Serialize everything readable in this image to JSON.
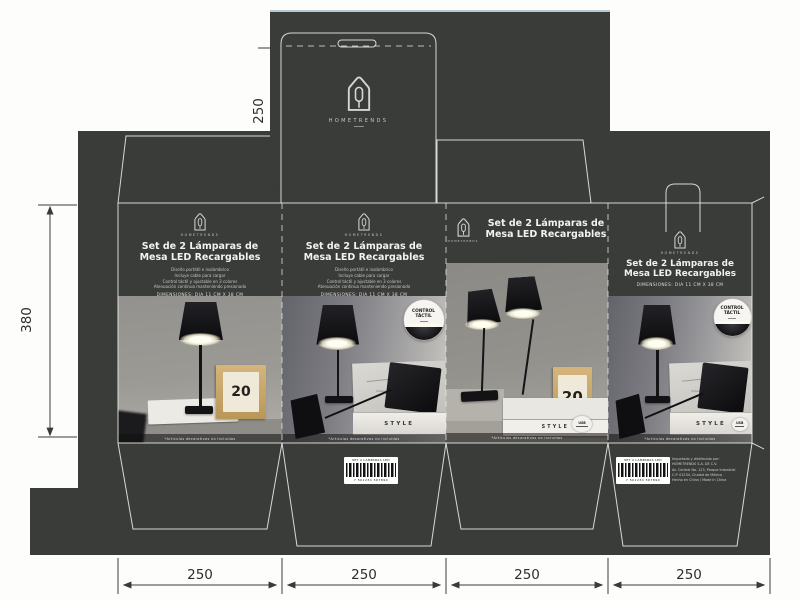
{
  "colors": {
    "sheet": "#3a3c39",
    "dieline": "#e9e9e4",
    "dimension_lines": "#3a3a3a",
    "calendar_wood": "#c9a869"
  },
  "brand": {
    "name": "HOMETRENDS"
  },
  "panel": {
    "title_line1": "Set de 2 Lámparas de",
    "title_line2": "Mesa LED Recargables",
    "features": [
      "Diseño portátil e inalámbrico",
      "Incluye cable para cargar",
      "Control táctil y ajustable en 3 colores",
      "Atenuación continua manteniendo presionado"
    ],
    "dimensions": "DIMENSIONES: DIA 11 CM  X 38 CM"
  },
  "badge": {
    "line1": "CONTROL",
    "line2": "TÁCTIL"
  },
  "photo": {
    "book_title": "STYLE",
    "calendar_day": "20",
    "caption": "*Artículos decorativos no incluidos",
    "cert_label": "USB"
  },
  "barcode": {
    "label": "SET 2 LÁMPARAS LED",
    "digits": "7 501234 567890"
  },
  "importer": [
    "Importado y distribuido por:",
    "HOMETRENDS S.A. DE C.V.",
    "Av. Central No. 123, Parque Industrial",
    "C.P. 01234, Ciudad de México",
    "Hecho en China / Made in China"
  ],
  "dims": {
    "top": "250",
    "left": "380",
    "bottom": [
      "250",
      "250",
      "250",
      "250"
    ]
  }
}
